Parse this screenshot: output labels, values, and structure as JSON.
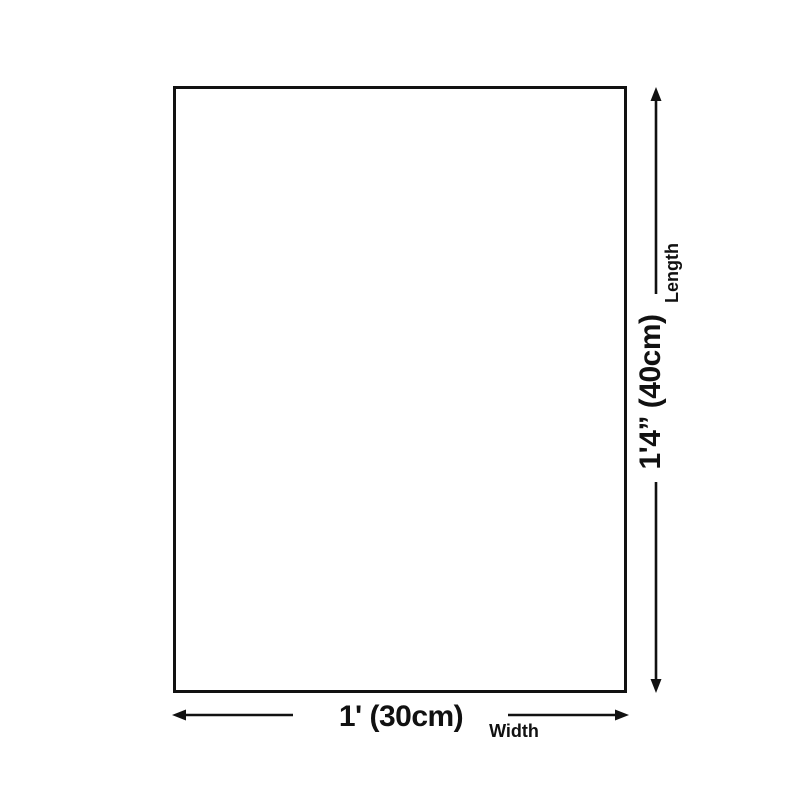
{
  "diagram": {
    "title_hint": "product dimension diagram",
    "panel": {
      "description": "blank rectangular canvas"
    },
    "length": {
      "value": "1'4” (40cm)",
      "label": "Length"
    },
    "width": {
      "value": "1' (30cm)",
      "label": "Width"
    },
    "colors": {
      "ink": "#111111",
      "background": "#ffffff"
    }
  }
}
